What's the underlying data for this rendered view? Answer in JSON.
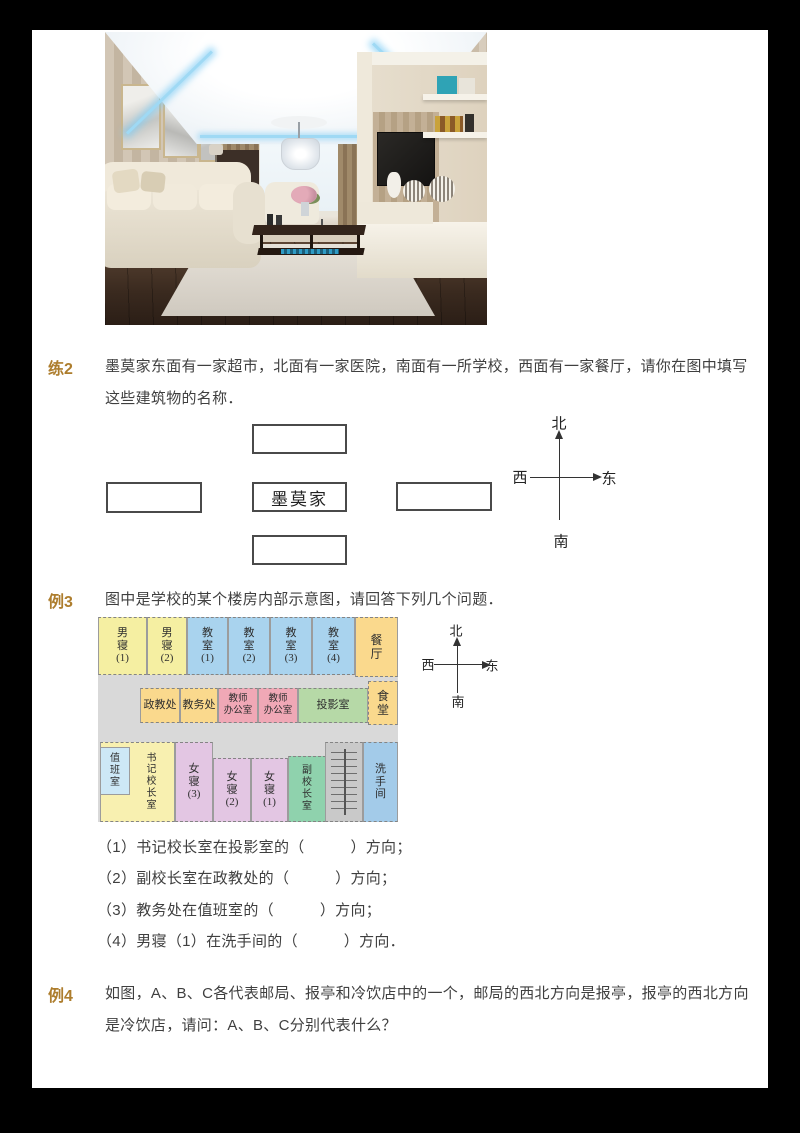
{
  "frame": {
    "border_color": "#000000",
    "paper_color": "#ffffff"
  },
  "practice2": {
    "label": "练2",
    "line1": "墨莫家东面有一家超市，北面有一家医院，南面有一所学校，西面有一家餐厅，请你在图中填写",
    "line2": "这些建筑物的名称．",
    "diagram": {
      "center_label": "墨莫家",
      "compass": {
        "north": "北",
        "south": "南",
        "west": "西",
        "east": "东"
      }
    }
  },
  "example3": {
    "label": "例3",
    "intro": "图中是学校的某个楼房内部示意图，请回答下列几个问题．",
    "compass": {
      "north": "北",
      "south": "南",
      "west": "西",
      "east": "东"
    },
    "floorplan": {
      "corridor_color": "#d9d9d9",
      "rooms": [
        {
          "label": "男\n寝\n(1)",
          "bg": "#f5efa2"
        },
        {
          "label": "男\n寝\n(2)",
          "bg": "#f5efa2"
        },
        {
          "label": "教\n室\n(1)",
          "bg": "#a9d3ee"
        },
        {
          "label": "教\n室\n(2)",
          "bg": "#a9d3ee"
        },
        {
          "label": "教\n室\n(3)",
          "bg": "#a9d3ee"
        },
        {
          "label": "教\n室\n(4)",
          "bg": "#a9d3ee"
        },
        {
          "label": "餐\n厅",
          "bg": "#fad98d"
        },
        {
          "label": "政教处",
          "bg": "#fad98d"
        },
        {
          "label": "教务处",
          "bg": "#fad98d"
        },
        {
          "label": "教师\n办公室",
          "bg": "#f0a8b6"
        },
        {
          "label": "教师\n办公室",
          "bg": "#f0a8b6"
        },
        {
          "label": "投影室",
          "bg": "#b6d9a7"
        },
        {
          "label": "食\n堂",
          "bg": "#fad98d"
        },
        {
          "label": "书\n记\n校\n长\n室",
          "bg": "#f8f0b0"
        },
        {
          "label": "值\n班\n室",
          "bg": "#cde8f6"
        },
        {
          "label": "女\n寝\n(3)",
          "bg": "#e3c6e3"
        },
        {
          "label": "女\n寝\n(2)",
          "bg": "#e3c6e3"
        },
        {
          "label": "女\n寝\n(1)",
          "bg": "#e3c6e3"
        },
        {
          "label": "副\n校\n长\n室",
          "bg": "#8fd2ad"
        },
        {
          "label": "",
          "bg": "#c9c9c9"
        },
        {
          "label": "洗\n手\n间",
          "bg": "#a3cbe9"
        }
      ]
    },
    "questions": [
      "（1）书记校长室在投影室的（　　　）方向；",
      "（2）副校长室在政教处的（　　　）方向；",
      "（3）教务处在值班室的（　　　）方向；",
      "（4）男寝（1）在洗手间的（　　　）方向．"
    ]
  },
  "example4": {
    "label": "例4",
    "line1": "如图，A、B、C各代表邮局、报亭和冷饮店中的一个，邮局的西北方向是报亭，报亭的西北方向",
    "line2": "是冷饮店，请问：A、B、C分别代表什么？"
  }
}
